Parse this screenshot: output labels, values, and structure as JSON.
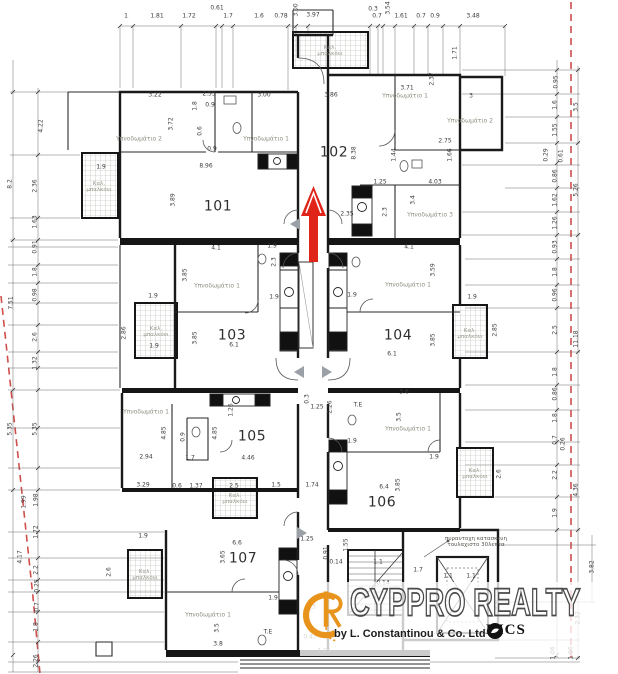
{
  "plan": {
    "apartment_labels": [
      {
        "t": "101",
        "x": 218,
        "y": 207
      },
      {
        "t": "102",
        "x": 334,
        "y": 153
      },
      {
        "t": "103",
        "x": 232,
        "y": 336
      },
      {
        "t": "104",
        "x": 398,
        "y": 336
      },
      {
        "t": "105",
        "x": 252,
        "y": 437
      },
      {
        "t": "106",
        "x": 382,
        "y": 503
      },
      {
        "t": "107",
        "x": 243,
        "y": 559
      }
    ],
    "room_labels": [
      {
        "t": "Υπνοδωμάτιο 2",
        "x": 139,
        "y": 140
      },
      {
        "t": "Υπνοδωμάτιο 1",
        "x": 266,
        "y": 140
      },
      {
        "t": "Υπνοδωμάτιο 1",
        "x": 405,
        "y": 97
      },
      {
        "t": "Υπνοδωμάτιο 2",
        "x": 470,
        "y": 122
      },
      {
        "t": "Υπνοδωμάτιο 3",
        "x": 430,
        "y": 216
      },
      {
        "t": "Υπνοδωμάτιο 1",
        "x": 217,
        "y": 287
      },
      {
        "t": "Υπνοδωμάτιο 1",
        "x": 408,
        "y": 286
      },
      {
        "t": "Υπνοδωμάτιο 1",
        "x": 146,
        "y": 413
      },
      {
        "t": "Υπνοδωμάτιο 1",
        "x": 408,
        "y": 430
      },
      {
        "t": "Υπνοδωμάτιο 1",
        "x": 208,
        "y": 616
      }
    ],
    "balcony_labels": [
      {
        "t": "Καλ.\nμπαλκόνι",
        "x": 330,
        "y": 51
      },
      {
        "t": "Καλ.\nμπαλκόνι",
        "x": 99,
        "y": 187
      },
      {
        "t": "Καλ.\nμπαλκόνι",
        "x": 156,
        "y": 332
      },
      {
        "t": "Καλ.\nμπαλκόνι",
        "x": 470,
        "y": 334
      },
      {
        "t": "Καλ.\nμπαλκόνι",
        "x": 235,
        "y": 499
      },
      {
        "t": "Καλ.\nμπαλκόνι",
        "x": 475,
        "y": 474
      },
      {
        "t": "Καλ.\nμπαλκόνι",
        "x": 145,
        "y": 575
      }
    ],
    "notes": [
      {
        "t": "πυραντοχη κατασκευη\nτουλαχιστο 30λεπτα",
        "x": 476,
        "y": 542
      }
    ],
    "dim_labels": [
      {
        "t": "1",
        "x": 126,
        "y": 17
      },
      {
        "t": "1.81",
        "x": 157,
        "y": 17
      },
      {
        "t": "1.72",
        "x": 189,
        "y": 17
      },
      {
        "t": "0.61",
        "x": 217,
        "y": 9
      },
      {
        "t": "1.7",
        "x": 228,
        "y": 17
      },
      {
        "t": "1.6",
        "x": 259,
        "y": 17
      },
      {
        "t": "0.78",
        "x": 281,
        "y": 17
      },
      {
        "t": "3.00",
        "x": 297,
        "y": 10,
        "r": 1
      },
      {
        "t": "3.97",
        "x": 313,
        "y": 16
      },
      {
        "t": "0.3",
        "x": 373,
        "y": 10
      },
      {
        "t": "0.7",
        "x": 377,
        "y": 17
      },
      {
        "t": "3.54",
        "x": 389,
        "y": 8,
        "r": 1
      },
      {
        "t": "1.61",
        "x": 401,
        "y": 17
      },
      {
        "t": "0.7",
        "x": 421,
        "y": 17
      },
      {
        "t": "0.9",
        "x": 435,
        "y": 17
      },
      {
        "t": "3.48",
        "x": 473,
        "y": 17
      },
      {
        "t": "4.22",
        "x": 42,
        "y": 126,
        "r": 1
      },
      {
        "t": "8.2",
        "x": 11,
        "y": 184,
        "r": 1
      },
      {
        "t": "2.36",
        "x": 36,
        "y": 186,
        "r": 1
      },
      {
        "t": "1.63",
        "x": 36,
        "y": 222,
        "r": 1
      },
      {
        "t": "0.91",
        "x": 36,
        "y": 247,
        "r": 1
      },
      {
        "t": "1.8",
        "x": 36,
        "y": 272,
        "r": 1
      },
      {
        "t": "0.98",
        "x": 36,
        "y": 295,
        "r": 1
      },
      {
        "t": "7.51",
        "x": 12,
        "y": 303,
        "r": 1
      },
      {
        "t": "2.6",
        "x": 36,
        "y": 337,
        "r": 1
      },
      {
        "t": "1.32",
        "x": 36,
        "y": 363,
        "r": 1
      },
      {
        "t": "5.35",
        "x": 11,
        "y": 429,
        "r": 1
      },
      {
        "t": "5.35",
        "x": 36,
        "y": 429,
        "r": 1
      },
      {
        "t": "1.99",
        "x": 25,
        "y": 502,
        "r": 1
      },
      {
        "t": "1.98",
        "x": 37,
        "y": 500,
        "r": 1
      },
      {
        "t": "1.72",
        "x": 37,
        "y": 532,
        "r": 1
      },
      {
        "t": "4.17",
        "x": 21,
        "y": 557,
        "r": 1
      },
      {
        "t": "2.2",
        "x": 37,
        "y": 570,
        "r": 1
      },
      {
        "t": "0.25",
        "x": 38,
        "y": 586,
        "r": 1
      },
      {
        "t": "0.7",
        "x": 38,
        "y": 607,
        "r": 1
      },
      {
        "t": "1.8",
        "x": 37,
        "y": 627,
        "r": 1
      },
      {
        "t": "2.26",
        "x": 37,
        "y": 661,
        "r": 1
      },
      {
        "t": "0.95",
        "x": 557,
        "y": 82,
        "r": 1
      },
      {
        "t": "1.6",
        "x": 556,
        "y": 105,
        "r": 1
      },
      {
        "t": "3.5",
        "x": 577,
        "y": 107,
        "r": 1
      },
      {
        "t": "1.55",
        "x": 556,
        "y": 130,
        "r": 1
      },
      {
        "t": "0.29",
        "x": 547,
        "y": 155,
        "r": 1
      },
      {
        "t": "0.61",
        "x": 562,
        "y": 156,
        "r": 1
      },
      {
        "t": "0.86",
        "x": 556,
        "y": 176,
        "r": 1
      },
      {
        "t": "5.26",
        "x": 577,
        "y": 190,
        "r": 1
      },
      {
        "t": "1.62",
        "x": 556,
        "y": 200,
        "r": 1
      },
      {
        "t": "1.26",
        "x": 556,
        "y": 223,
        "r": 1
      },
      {
        "t": "0.93",
        "x": 556,
        "y": 247,
        "r": 1
      },
      {
        "t": "1.8",
        "x": 556,
        "y": 272,
        "r": 1
      },
      {
        "t": "0.96",
        "x": 556,
        "y": 295,
        "r": 1
      },
      {
        "t": "2.5",
        "x": 556,
        "y": 330,
        "r": 1
      },
      {
        "t": "11.18",
        "x": 577,
        "y": 339,
        "r": 1
      },
      {
        "t": "1.8",
        "x": 556,
        "y": 372,
        "r": 1
      },
      {
        "t": "0.86",
        "x": 556,
        "y": 394,
        "r": 1
      },
      {
        "t": "1.8",
        "x": 556,
        "y": 418,
        "r": 1
      },
      {
        "t": "0.7",
        "x": 556,
        "y": 440,
        "r": 1
      },
      {
        "t": "0.26",
        "x": 564,
        "y": 444,
        "r": 1
      },
      {
        "t": "2.2",
        "x": 556,
        "y": 475,
        "r": 1
      },
      {
        "t": "4.36",
        "x": 577,
        "y": 490,
        "r": 1
      },
      {
        "t": "1.9",
        "x": 556,
        "y": 513,
        "r": 1
      },
      {
        "t": "3.82",
        "x": 593,
        "y": 567,
        "r": 1
      },
      {
        "t": "2.32",
        "x": 579,
        "y": 618,
        "r": 1
      },
      {
        "t": "1.06",
        "x": 554,
        "y": 653,
        "r": 1
      },
      {
        "t": "1.06",
        "x": 572,
        "y": 653,
        "r": 1
      },
      {
        "t": "3.22",
        "x": 155,
        "y": 96
      },
      {
        "t": "2.55",
        "x": 209,
        "y": 95
      },
      {
        "t": "3.00",
        "x": 264,
        "y": 96
      },
      {
        "t": "3.72",
        "x": 172,
        "y": 124,
        "r": 1
      },
      {
        "t": "1.8",
        "x": 196,
        "y": 106,
        "r": 1
      },
      {
        "t": "0.9",
        "x": 210,
        "y": 106
      },
      {
        "t": "0.6",
        "x": 201,
        "y": 131,
        "r": 1
      },
      {
        "t": "0.9",
        "x": 212,
        "y": 150
      },
      {
        "t": "8.96",
        "x": 206,
        "y": 167
      },
      {
        "t": "3.89",
        "x": 174,
        "y": 200,
        "r": 1
      },
      {
        "t": "1.9",
        "x": 101,
        "y": 168
      },
      {
        "t": "3.86",
        "x": 331,
        "y": 96
      },
      {
        "t": "3.71",
        "x": 407,
        "y": 89
      },
      {
        "t": "3",
        "x": 471,
        "y": 97
      },
      {
        "t": "1.71",
        "x": 456,
        "y": 53,
        "r": 1
      },
      {
        "t": "2.37",
        "x": 433,
        "y": 79,
        "r": 1
      },
      {
        "t": "8.38",
        "x": 355,
        "y": 153,
        "r": 1
      },
      {
        "t": "1.44",
        "x": 395,
        "y": 155,
        "r": 1
      },
      {
        "t": "2.75",
        "x": 445,
        "y": 142
      },
      {
        "t": "1.66",
        "x": 451,
        "y": 155,
        "r": 1
      },
      {
        "t": "4.03",
        "x": 435,
        "y": 183
      },
      {
        "t": "1.25",
        "x": 380,
        "y": 183
      },
      {
        "t": "3.4",
        "x": 414,
        "y": 200,
        "r": 1
      },
      {
        "t": "2.35",
        "x": 347,
        "y": 215
      },
      {
        "t": "2.3",
        "x": 386,
        "y": 212,
        "r": 1
      },
      {
        "t": "4.1",
        "x": 216,
        "y": 249
      },
      {
        "t": "1.9",
        "x": 272,
        "y": 247
      },
      {
        "t": "3.85",
        "x": 186,
        "y": 275,
        "r": 1
      },
      {
        "t": "2.3",
        "x": 275,
        "y": 262,
        "r": 1
      },
      {
        "t": "1.9",
        "x": 153,
        "y": 297
      },
      {
        "t": "1.9",
        "x": 274,
        "y": 298
      },
      {
        "t": "2.86",
        "x": 125,
        "y": 333,
        "r": 1
      },
      {
        "t": "1.9",
        "x": 154,
        "y": 347
      },
      {
        "t": "6.1",
        "x": 234,
        "y": 346
      },
      {
        "t": "3.85",
        "x": 196,
        "y": 338,
        "r": 1
      },
      {
        "t": "4.1",
        "x": 409,
        "y": 248
      },
      {
        "t": "3.59",
        "x": 434,
        "y": 270,
        "r": 1
      },
      {
        "t": "1.9",
        "x": 352,
        "y": 296
      },
      {
        "t": "1.9",
        "x": 472,
        "y": 298
      },
      {
        "t": "2.85",
        "x": 496,
        "y": 330,
        "r": 1
      },
      {
        "t": "6.1",
        "x": 392,
        "y": 355
      },
      {
        "t": "3.85",
        "x": 434,
        "y": 340,
        "r": 1
      },
      {
        "t": "1.25",
        "x": 317,
        "y": 408
      },
      {
        "t": "0.3",
        "x": 308,
        "y": 399,
        "r": 1
      },
      {
        "t": "4.85",
        "x": 165,
        "y": 433,
        "r": 1
      },
      {
        "t": "4.85",
        "x": 216,
        "y": 433,
        "r": 1
      },
      {
        "t": "1.26",
        "x": 232,
        "y": 410,
        "r": 1
      },
      {
        "t": "0.9",
        "x": 184,
        "y": 437,
        "r": 1
      },
      {
        "t": "2.94",
        "x": 146,
        "y": 458
      },
      {
        "t": "1.7",
        "x": 190,
        "y": 459
      },
      {
        "t": "4.46",
        "x": 248,
        "y": 459
      },
      {
        "t": "3.29",
        "x": 143,
        "y": 486
      },
      {
        "t": "0.6",
        "x": 177,
        "y": 487
      },
      {
        "t": "1.37",
        "x": 196,
        "y": 487
      },
      {
        "t": "2.5",
        "x": 234,
        "y": 487
      },
      {
        "t": "1.5",
        "x": 276,
        "y": 486
      },
      {
        "t": "1.74",
        "x": 312,
        "y": 486
      },
      {
        "t": "2.26",
        "x": 331,
        "y": 407,
        "r": 1
      },
      {
        "t": "3.6",
        "x": 404,
        "y": 393
      },
      {
        "t": "3.5",
        "x": 400,
        "y": 417,
        "r": 1
      },
      {
        "t": "T.E",
        "x": 358,
        "y": 406
      },
      {
        "t": "1.9",
        "x": 352,
        "y": 442
      },
      {
        "t": "6.4",
        "x": 384,
        "y": 488
      },
      {
        "t": "3.85",
        "x": 399,
        "y": 485,
        "r": 1
      },
      {
        "t": "1.9",
        "x": 434,
        "y": 458
      },
      {
        "t": "2.6",
        "x": 500,
        "y": 474,
        "r": 1
      },
      {
        "t": "1.9",
        "x": 143,
        "y": 537
      },
      {
        "t": "2.6",
        "x": 110,
        "y": 572,
        "r": 1
      },
      {
        "t": "6.6",
        "x": 237,
        "y": 544
      },
      {
        "t": "3.65",
        "x": 224,
        "y": 557,
        "r": 1
      },
      {
        "t": "1.9",
        "x": 273,
        "y": 599
      },
      {
        "t": "3.5",
        "x": 218,
        "y": 628,
        "r": 1
      },
      {
        "t": "3.8",
        "x": 218,
        "y": 645
      },
      {
        "t": "T.E",
        "x": 268,
        "y": 633
      },
      {
        "t": "1.3",
        "x": 311,
        "y": 608
      },
      {
        "t": "0.47",
        "x": 310,
        "y": 638
      },
      {
        "t": "1.25",
        "x": 324,
        "y": 652
      },
      {
        "t": "1.25",
        "x": 307,
        "y": 540
      },
      {
        "t": "1.55",
        "x": 347,
        "y": 545,
        "r": 1
      },
      {
        "t": "0.91",
        "x": 327,
        "y": 553,
        "r": 1
      },
      {
        "t": "0.14",
        "x": 336,
        "y": 563
      },
      {
        "t": "1.1",
        "x": 378,
        "y": 563
      },
      {
        "t": "1.7",
        "x": 418,
        "y": 571
      },
      {
        "t": "1.1",
        "x": 448,
        "y": 577
      },
      {
        "t": "1.1",
        "x": 471,
        "y": 577
      },
      {
        "t": "0.14",
        "x": 383,
        "y": 584
      },
      {
        "t": "4.9",
        "x": 498,
        "y": 605,
        "r": 1
      }
    ]
  },
  "watermark": {
    "brand": "CYPPRO REALTY",
    "byline": "by L. Constantinou & Co. Ltd",
    "rics": "RICS"
  },
  "colors": {
    "boundary": "#cf4f4c",
    "arrow": "#e02419",
    "monogram": "#e8941c",
    "wall": "#1a1a1a"
  }
}
